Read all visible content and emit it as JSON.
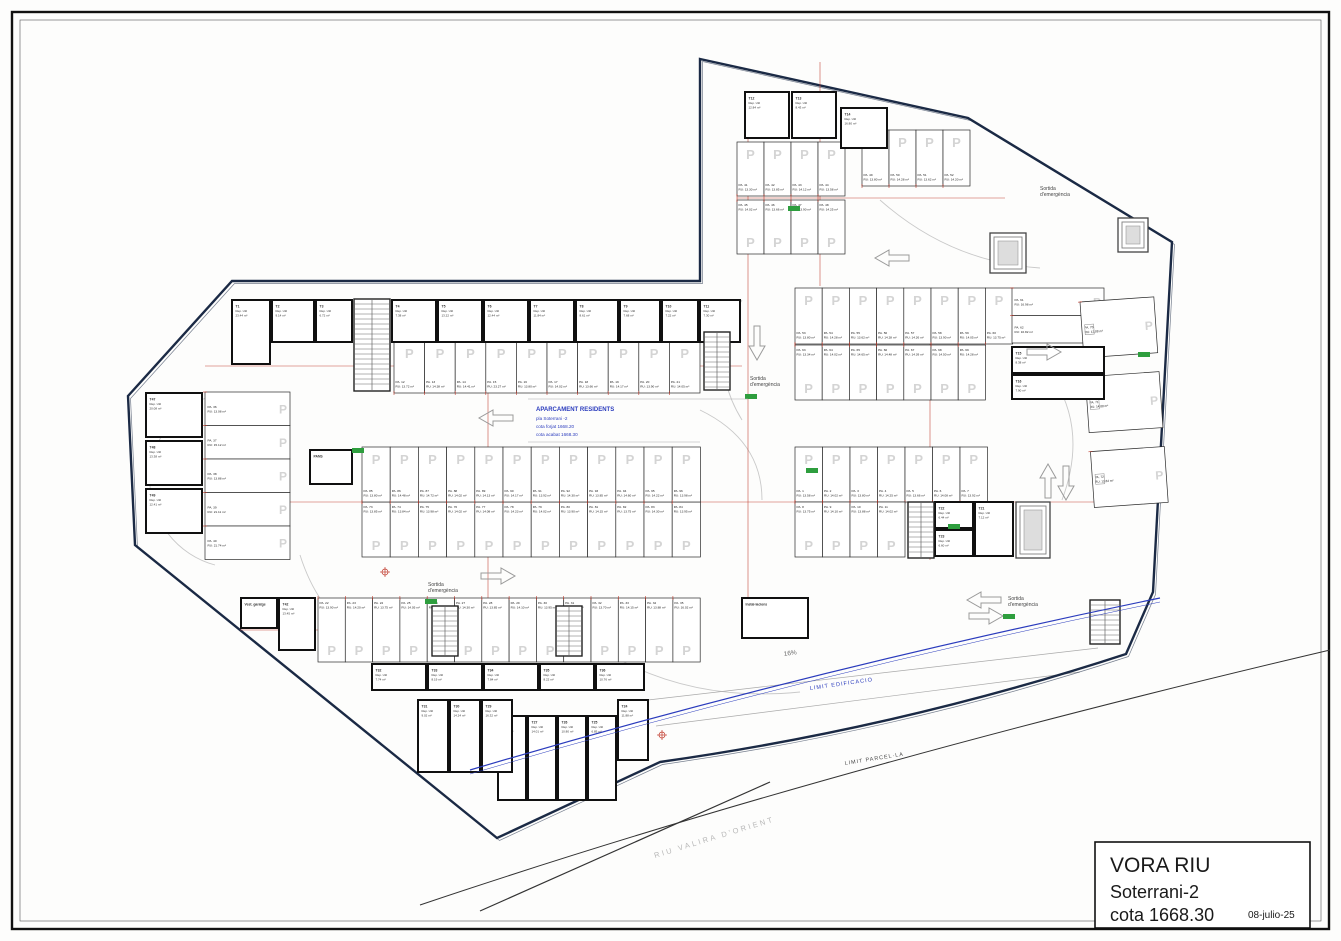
{
  "title_block": {
    "project": "VORA RIU",
    "level": "Soterrani-2",
    "cota": "cota 1668.30",
    "date": "08-julio-25"
  },
  "center_note": {
    "title": "APARCAMENT RESIDENTS",
    "lines": [
      "pla Soterrani -2",
      "cota forjat 1668.20",
      "cota acabat 1668.30"
    ]
  },
  "labels": {
    "emergency_line1": "Sortida",
    "emergency_line2": "d'emergència",
    "limit_edificacio": "LIMIT EDIFICACIO",
    "limit_parcella": "LIMIT PARCEL·LA",
    "river": "RIU VALIRA D'ORIENT",
    "ramp": "16%",
    "stall_prefix": "PA.",
    "stall_area_prefix": "RU:",
    "sqm": "m²",
    "room_use": "Rep. Util",
    "p_mark": "P"
  },
  "colors": {
    "boundary": "#1b2a45",
    "wall": "#101010",
    "stall": "#2a2a2a",
    "dim": "#c0392b",
    "p": "#d4d4d4",
    "blue": "#2a3bbd",
    "green": "#2e9e3e",
    "arc": "#c9c9c9",
    "arrow": "#9a9a9a"
  },
  "parking_banks": [
    {
      "id": "right-block-upper-row",
      "start": 1,
      "x": 795,
      "y": 447,
      "sw": 27.5,
      "sh": 55,
      "count": 7,
      "dir": "v",
      "label": "bottom",
      "areas": [
        "13.58",
        "14.02",
        "13.80",
        "14.25",
        "13.66",
        "14.08",
        "13.92"
      ]
    },
    {
      "id": "right-block-lower-row",
      "start": 8,
      "x": 795,
      "y": 502,
      "sw": 27.5,
      "sh": 55,
      "count": 4,
      "dir": "v",
      "label": "top",
      "areas": [
        "13.75",
        "14.10",
        "13.88",
        "14.02"
      ]
    },
    {
      "id": "left-wing-top-row",
      "start": 12,
      "x": 394,
      "y": 341,
      "sw": 30.6,
      "sh": 52,
      "count": 10,
      "dir": "v",
      "label": "bottom",
      "areas": [
        "13.72",
        "14.38",
        "14.41",
        "23.27",
        "13.80",
        "14.02",
        "13.66",
        "14.17",
        "13.90",
        "14.05"
      ]
    },
    {
      "id": "bottom-row",
      "start": 22,
      "x": 318,
      "y": 598,
      "sw": 27.3,
      "sh": 64,
      "count": 14,
      "dir": "v",
      "label": "top",
      "areas": [
        "13.90",
        "14.20",
        "13.75",
        "14.05",
        "13.60",
        "14.30",
        "13.85",
        "14.10",
        "13.95",
        "14.22",
        "13.70",
        "14.15",
        "13.88",
        "16.02"
      ]
    },
    {
      "id": "left-edge-strip",
      "start": 36,
      "x": 205,
      "y": 392,
      "sw": 85,
      "sh": 33.5,
      "count": 5,
      "dir": "h",
      "label": "left",
      "areas": [
        "13.08",
        "15.12",
        "13.88",
        "21.11",
        "21.74"
      ]
    },
    {
      "id": "upper-wing-row-1",
      "start": 41,
      "x": 737,
      "y": 142,
      "sw": 27,
      "sh": 54,
      "count": 4,
      "dir": "v",
      "label": "bottom",
      "areas": [
        "13.30",
        "13.85",
        "14.12",
        "13.58"
      ]
    },
    {
      "id": "upper-wing-row-2",
      "start": 45,
      "x": 737,
      "y": 200,
      "sw": 27,
      "sh": 54,
      "count": 4,
      "dir": "v",
      "label": "top",
      "areas": [
        "14.02",
        "13.66",
        "13.90",
        "14.25"
      ]
    },
    {
      "id": "upper-wing-row-3",
      "start": 49,
      "x": 862,
      "y": 130,
      "sw": 27,
      "sh": 56,
      "count": 4,
      "dir": "v",
      "label": "bottom",
      "areas": [
        "13.80",
        "14.28",
        "13.62",
        "14.20"
      ]
    },
    {
      "id": "right-center-row-1",
      "start": 53,
      "x": 795,
      "y": 288,
      "sw": 27.2,
      "sh": 56,
      "count": 8,
      "dir": "v",
      "label": "bottom",
      "areas": [
        "13.80",
        "14.28",
        "13.62",
        "14.28",
        "14.26",
        "13.90",
        "14.05",
        "13.75"
      ]
    },
    {
      "id": "right-center-horizontal-pair",
      "start": 61,
      "x": 1012,
      "y": 288,
      "sw": 92,
      "sh": 27.5,
      "count": 2,
      "dir": "h",
      "label": "left",
      "areas": [
        "16.98",
        "16.82"
      ]
    },
    {
      "id": "right-center-row-2",
      "start": 63,
      "x": 795,
      "y": 345,
      "sw": 27.2,
      "sh": 55,
      "count": 7,
      "dir": "v",
      "label": "top",
      "areas": [
        "13.34",
        "14.02",
        "14.65",
        "14.48",
        "14.39",
        "14.50",
        "14.28"
      ]
    },
    {
      "id": "right-edge-strip",
      "start": 70,
      "x": 1080,
      "y": 302,
      "sw": 74,
      "sh": 56,
      "count": 3,
      "gap": 19,
      "rotate": -4,
      "dir": "h",
      "label": "left",
      "areas": [
        "13.88",
        "14.88",
        "13.84"
      ]
    },
    {
      "id": "center-bank-lower",
      "start": 73,
      "x": 362,
      "y": 502,
      "sw": 28.2,
      "sh": 55,
      "count": 12,
      "dir": "v",
      "label": "top",
      "areas": [
        "13.85",
        "13.84",
        "13.98",
        "14.02",
        "14.08",
        "14.23",
        "14.02",
        "13.90",
        "14.15",
        "13.75",
        "14.30",
        "13.95"
      ]
    },
    {
      "id": "center-bank-upper",
      "start": 85,
      "x": 362,
      "y": 447,
      "sw": 28.2,
      "sh": 55,
      "count": 12,
      "dir": "v",
      "label": "bottom",
      "areas": [
        "13.80",
        "14.48",
        "14.72",
        "14.02",
        "14.13",
        "14.17",
        "13.92",
        "14.30",
        "13.85",
        "14.60",
        "14.22",
        "13.98"
      ]
    }
  ],
  "rooms": [
    [
      "T1",
      "23.44",
      232,
      300,
      38,
      64
    ],
    [
      "T2",
      "9.14",
      272,
      300,
      42,
      42
    ],
    [
      "T3",
      "6.72",
      316,
      300,
      36,
      42
    ],
    [
      "T4",
      "7.38",
      392,
      300,
      44,
      42
    ],
    [
      "T5",
      "13.22",
      438,
      300,
      44,
      42
    ],
    [
      "T6",
      "12.44",
      484,
      300,
      44,
      42
    ],
    [
      "T7",
      "11.84",
      530,
      300,
      44,
      42
    ],
    [
      "T8",
      "8.61",
      576,
      300,
      42,
      42
    ],
    [
      "T9",
      "7.68",
      620,
      300,
      40,
      42
    ],
    [
      "T10",
      "7.22",
      662,
      300,
      36,
      42
    ],
    [
      "T11",
      "7.30",
      700,
      300,
      40,
      42
    ],
    [
      "T12",
      "12.84",
      745,
      92,
      44,
      46
    ],
    [
      "T13",
      "8.43",
      792,
      92,
      44,
      46
    ],
    [
      "T14",
      "16.80",
      841,
      108,
      46,
      40
    ],
    [
      "T15",
      "8.38",
      1012,
      347,
      92,
      26
    ],
    [
      "T16",
      "7.90",
      1012,
      375,
      92,
      24
    ],
    [
      "T21",
      "7.12",
      975,
      502,
      38,
      54
    ],
    [
      "T22",
      "6.44",
      935,
      502,
      38,
      26
    ],
    [
      "T23",
      "6.60",
      935,
      530,
      38,
      26
    ],
    [
      "T24",
      "11.88",
      618,
      700,
      30,
      60
    ],
    [
      "T25",
      "6.85",
      588,
      716,
      28,
      84
    ],
    [
      "T26",
      "10.80",
      558,
      716,
      28,
      84
    ],
    [
      "T27",
      "14.01",
      528,
      716,
      28,
      84
    ],
    [
      "T28",
      "17.85",
      498,
      716,
      28,
      84
    ],
    [
      "T29",
      "16.32",
      482,
      700,
      30,
      72
    ],
    [
      "T30",
      "14.24",
      450,
      700,
      30,
      72
    ],
    [
      "T31",
      "9.02",
      418,
      700,
      30,
      72
    ],
    [
      "T32",
      "7.74",
      372,
      664,
      54,
      26
    ],
    [
      "T33",
      "8.19",
      428,
      664,
      54,
      26
    ],
    [
      "T34",
      "7.84",
      484,
      664,
      54,
      26
    ],
    [
      "T35",
      "8.22",
      540,
      664,
      54,
      26
    ],
    [
      "T36",
      "10.76",
      596,
      664,
      48,
      26
    ],
    [
      "T42",
      "13.45",
      279,
      598,
      36,
      52
    ],
    [
      "Vest. garatge",
      "",
      241,
      598,
      36,
      30
    ],
    [
      "T47",
      "20.08",
      146,
      393,
      56,
      44
    ],
    [
      "T48",
      "13.38",
      146,
      441,
      56,
      44
    ],
    [
      "T49",
      "12.41",
      146,
      489,
      56,
      44
    ],
    [
      "PANS",
      "",
      310,
      450,
      42,
      34
    ],
    [
      "Instal·lacions",
      "",
      742,
      598,
      66,
      40
    ]
  ],
  "emergency_exits": [
    [
      750,
      380
    ],
    [
      1040,
      190
    ],
    [
      428,
      586
    ],
    [
      1008,
      600
    ]
  ],
  "arrows": [
    {
      "x": 893,
      "y": 258,
      "rot": 180
    },
    {
      "x": 1043,
      "y": 352,
      "rot": 0
    },
    {
      "x": 497,
      "y": 418,
      "rot": 180
    },
    {
      "x": 497,
      "y": 576,
      "rot": 0
    },
    {
      "x": 1048,
      "y": 482,
      "rot": 270
    },
    {
      "x": 1066,
      "y": 482,
      "rot": 90
    },
    {
      "x": 757,
      "y": 342,
      "rot": 90
    },
    {
      "x": 985,
      "y": 600,
      "rot": 180
    },
    {
      "x": 985,
      "y": 616,
      "rot": 0
    }
  ],
  "cores": [
    {
      "type": "stair",
      "x": 354,
      "y": 299,
      "w": 36,
      "h": 92
    },
    {
      "type": "stair",
      "x": 704,
      "y": 332,
      "w": 26,
      "h": 58
    },
    {
      "type": "lift",
      "x": 990,
      "y": 233,
      "w": 36,
      "h": 40
    },
    {
      "type": "lift",
      "x": 1118,
      "y": 218,
      "w": 30,
      "h": 34
    },
    {
      "type": "lift",
      "x": 1016,
      "y": 502,
      "w": 34,
      "h": 56
    },
    {
      "type": "stair",
      "x": 908,
      "y": 502,
      "w": 26,
      "h": 56
    },
    {
      "type": "stair",
      "x": 432,
      "y": 606,
      "w": 26,
      "h": 50
    },
    {
      "type": "stair",
      "x": 556,
      "y": 606,
      "w": 26,
      "h": 50
    },
    {
      "type": "stair",
      "x": 1090,
      "y": 600,
      "w": 30,
      "h": 44
    }
  ],
  "survey_marks": [
    [
      488,
      366
    ],
    [
      488,
      502
    ],
    [
      660,
      630
    ],
    [
      818,
      502
    ],
    [
      930,
      318
    ],
    [
      748,
      228
    ],
    [
      283,
      610
    ],
    [
      1035,
      366
    ],
    [
      385,
      572
    ],
    [
      662,
      735
    ]
  ],
  "green_ticks": [
    [
      352,
      448
    ],
    [
      806,
      468
    ],
    [
      948,
      524
    ],
    [
      788,
      206
    ],
    [
      1138,
      352
    ],
    [
      745,
      394
    ],
    [
      425,
      599
    ],
    [
      1003,
      614
    ]
  ],
  "aisle_lines": [
    [
      205,
      366,
      742,
      366
    ],
    [
      205,
      502,
      1160,
      502
    ],
    [
      795,
      318,
      1105,
      318
    ],
    [
      737,
      198,
      1005,
      198
    ],
    [
      240,
      630,
      700,
      630
    ],
    [
      748,
      118,
      748,
      630
    ],
    [
      488,
      300,
      488,
      662
    ],
    [
      930,
      288,
      930,
      560
    ],
    [
      820,
      62,
      820,
      286
    ]
  ],
  "arcs": [
    "M 215,395 A 88 88 0 0 0 215,565",
    "M 300,555 Q 330,650 430,662",
    "M 700,410 Q 762,440 762,500",
    "M 880,200 Q 950,262 1040,268",
    "M 1040,360 Q 1092,420 1062,500",
    "M 620,660 Q 700,702 800,692",
    "M 742,300 Q 705,360 742,420"
  ],
  "boundary_path": "M 700,59 L 968,118 L 1172,242 L 1153,592 L 1126,654 Q 900,728 660,762 L 497,838 L 135,545 L 128,396 L 232,281 L 700,281 Z",
  "ramp_lines": [
    [
      648,
      700,
      1098,
      648
    ],
    [
      656,
      726,
      1080,
      672
    ]
  ]
}
